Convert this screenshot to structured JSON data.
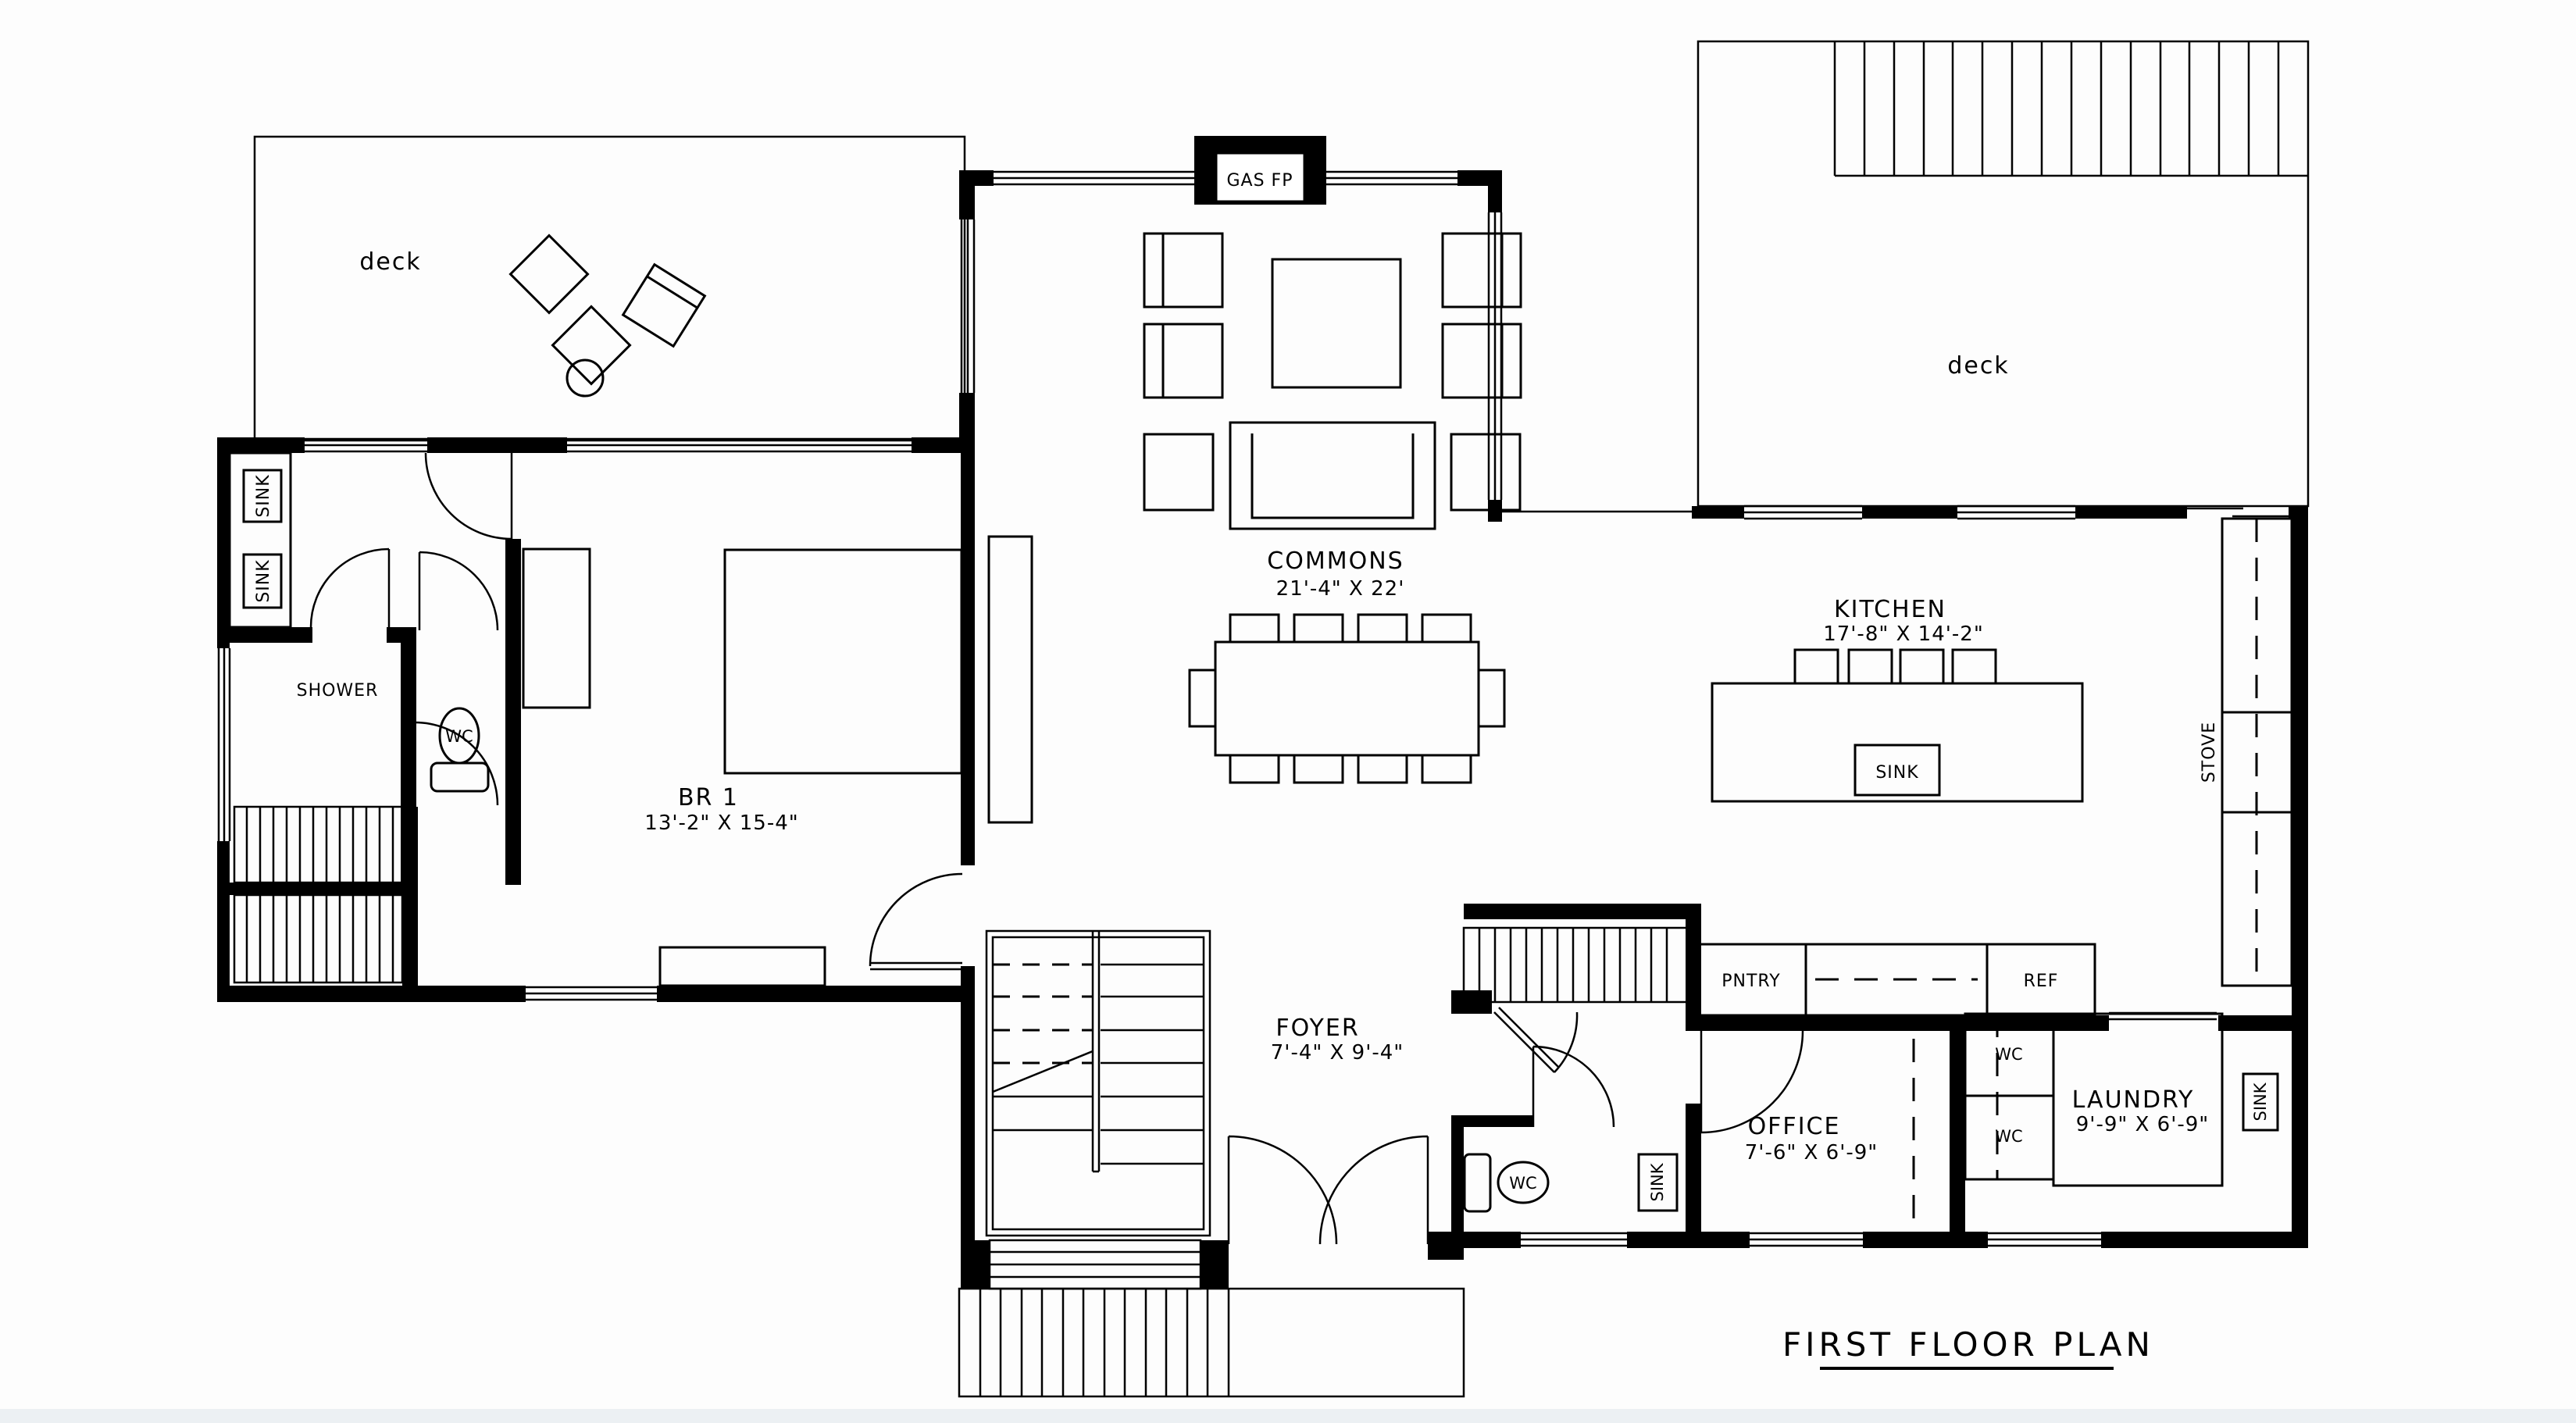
{
  "title": "FIRST FLOOR PLAN",
  "rooms": {
    "commons": {
      "name": "COMMONS",
      "dims": "21'-4\" X 22'"
    },
    "kitchen": {
      "name": "KITCHEN",
      "dims": "17'-8\" X 14'-2\""
    },
    "br1": {
      "name": "BR 1",
      "dims": "13'-2\" X 15-4\""
    },
    "foyer": {
      "name": "FOYER",
      "dims": "7'-4\" X 9'-4\""
    },
    "office": {
      "name": "OFFICE",
      "dims": "7'-6\" X 6'-9\""
    },
    "laundry": {
      "name": "LAUNDRY",
      "dims": "9'-9\" X 6'-9\""
    }
  },
  "areas": {
    "deck_left": "deck",
    "deck_right": "deck"
  },
  "fixtures": {
    "gas_fireplace": "GAS FP",
    "sink": "SINK",
    "shower": "SHOWER",
    "toilet": "WC",
    "pantry": "PNTRY",
    "refrigerator": "REF",
    "stove": "STOVE"
  },
  "colors": {
    "ink": "#000000",
    "paper": "#ffffff"
  }
}
